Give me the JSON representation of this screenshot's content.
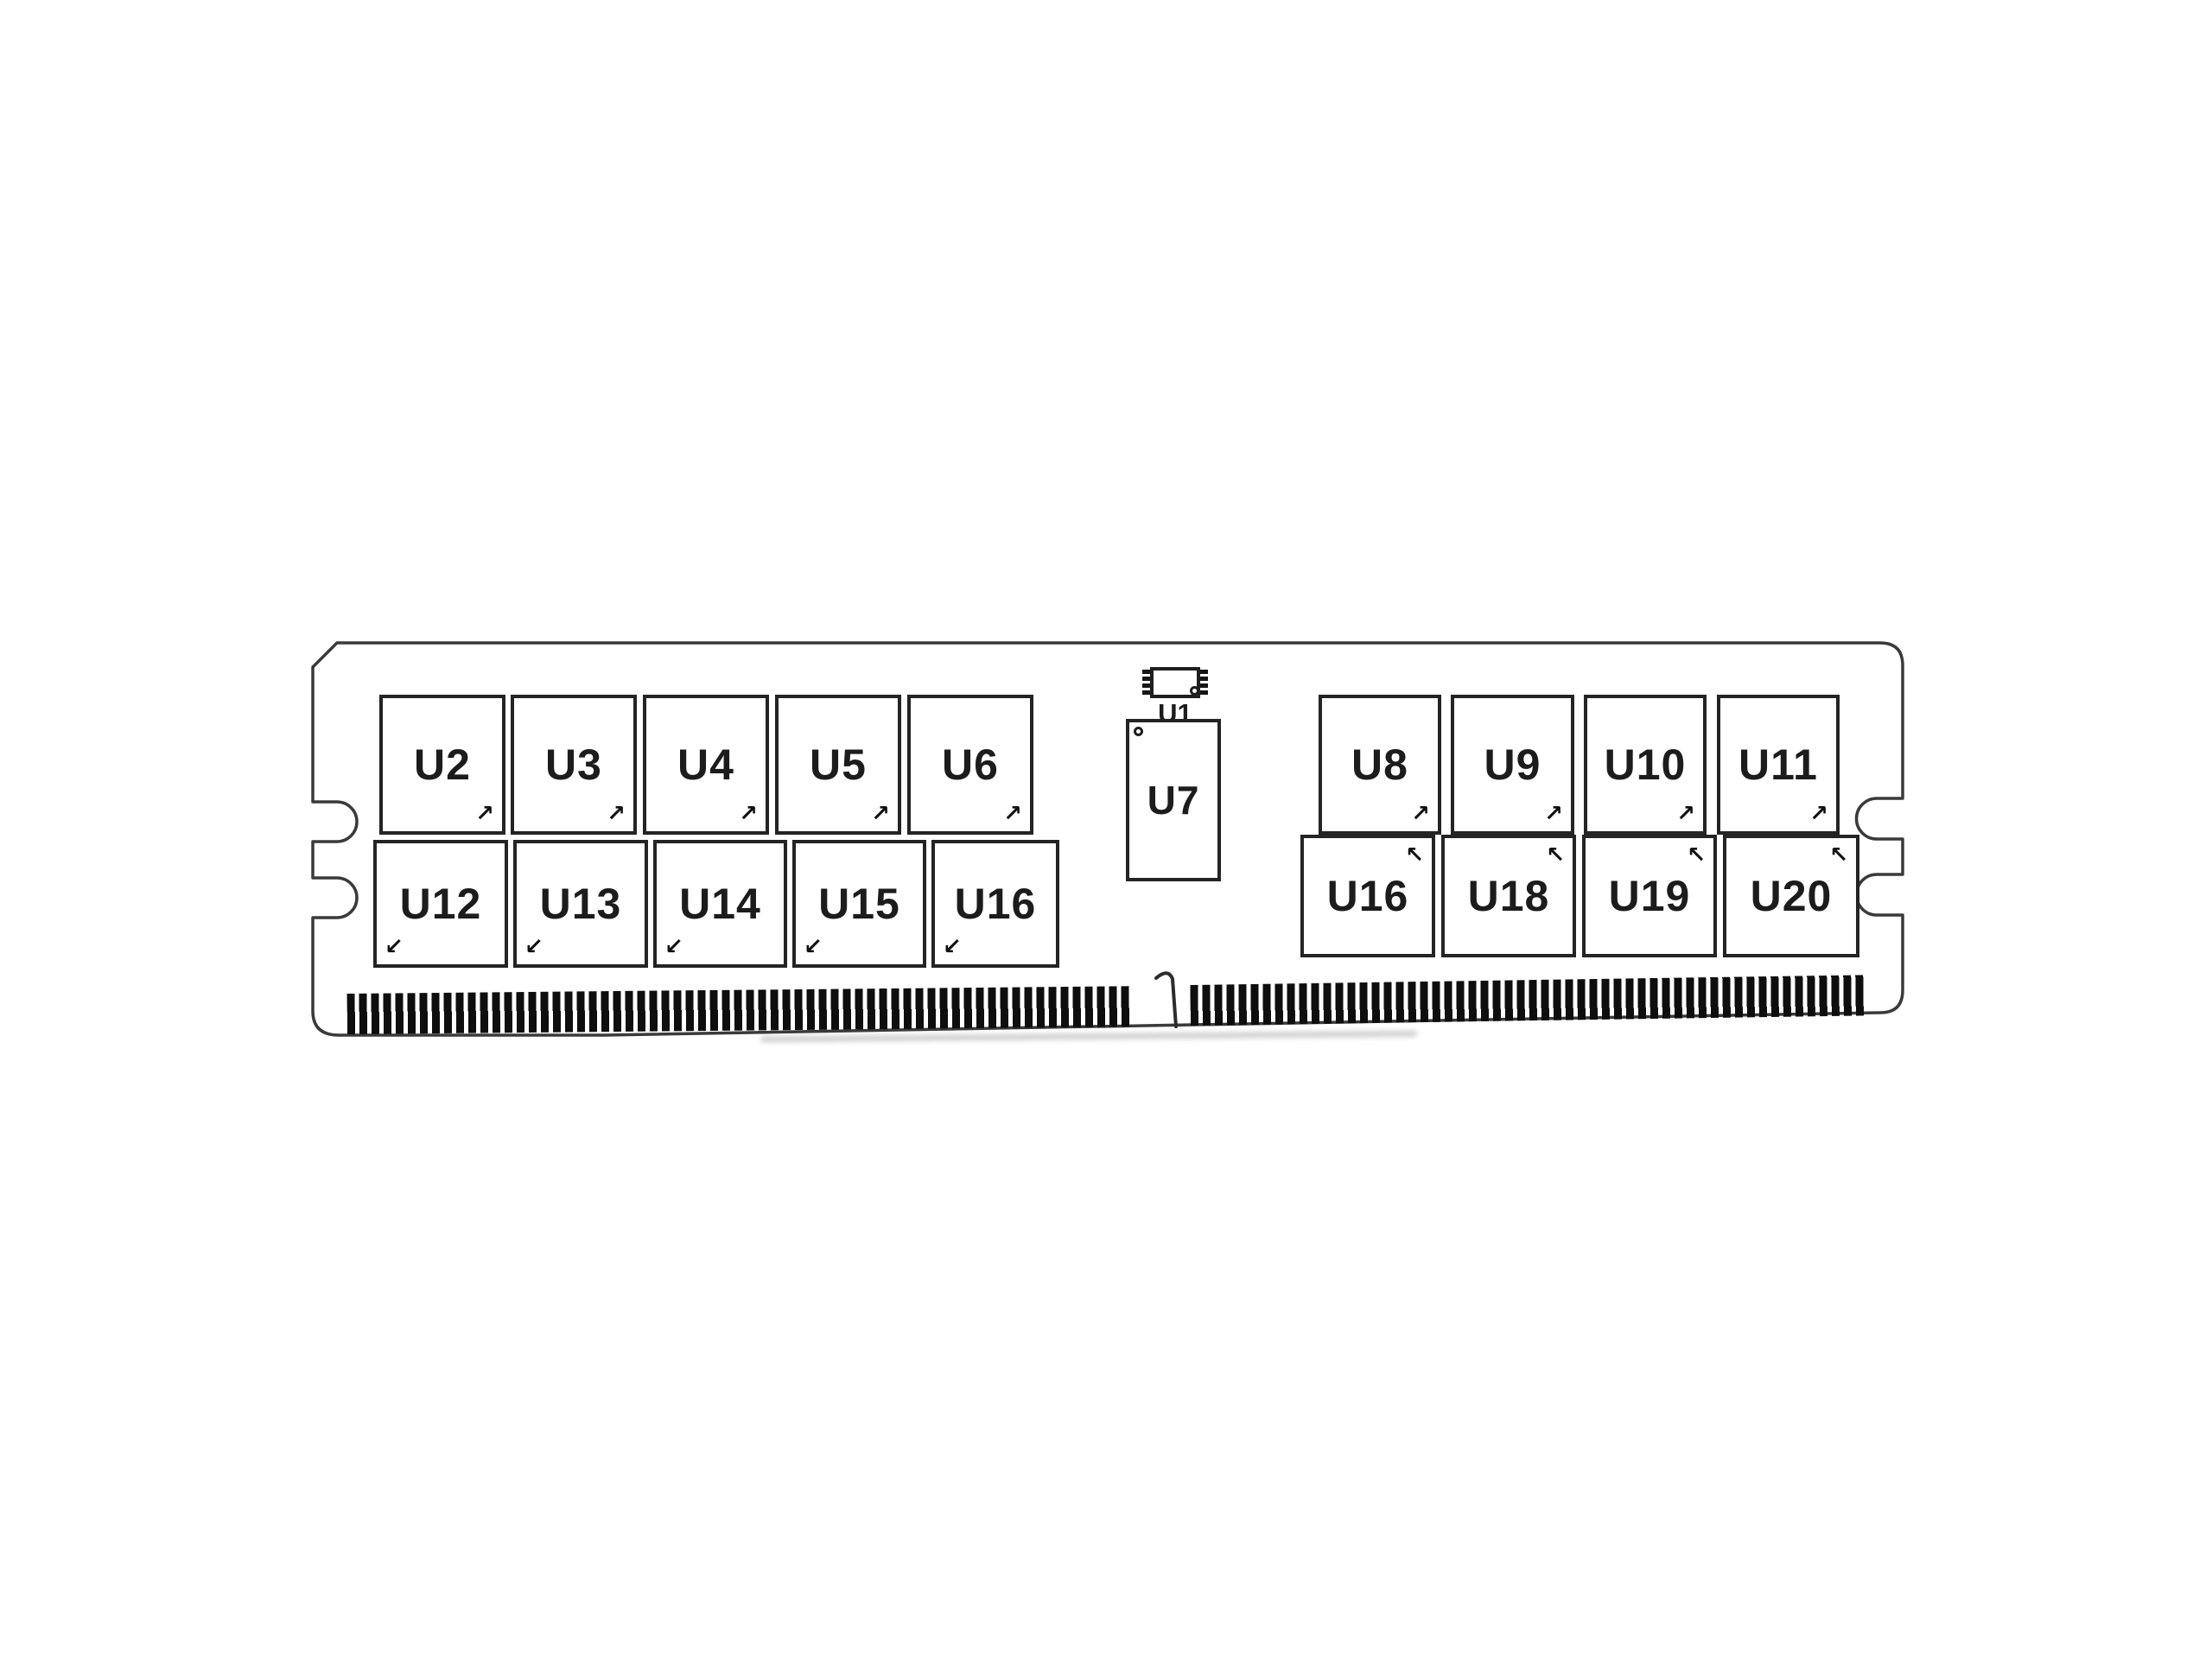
{
  "diagram": {
    "name": "Memory module component layout (top view)",
    "background": "#ffffff",
    "outline_color": "#3a3a3a",
    "chip_border_color": "#242424",
    "label_color": "#1c1c1c",
    "pin_color": "#0e0e0e"
  },
  "chips": {
    "top_left": [
      "U2",
      "U3",
      "U4",
      "U5",
      "U6"
    ],
    "bottom_left": [
      "U12",
      "U13",
      "U14",
      "U15",
      "U16"
    ],
    "top_right": [
      "U8",
      "U9",
      "U10",
      "U11"
    ],
    "bottom_right": [
      "U16",
      "U18",
      "U19",
      "U20"
    ],
    "spd_label": "U1",
    "register_label": "U7"
  },
  "markers": {
    "up_right": "↗",
    "down_left": "↙",
    "up_left": "↖"
  }
}
